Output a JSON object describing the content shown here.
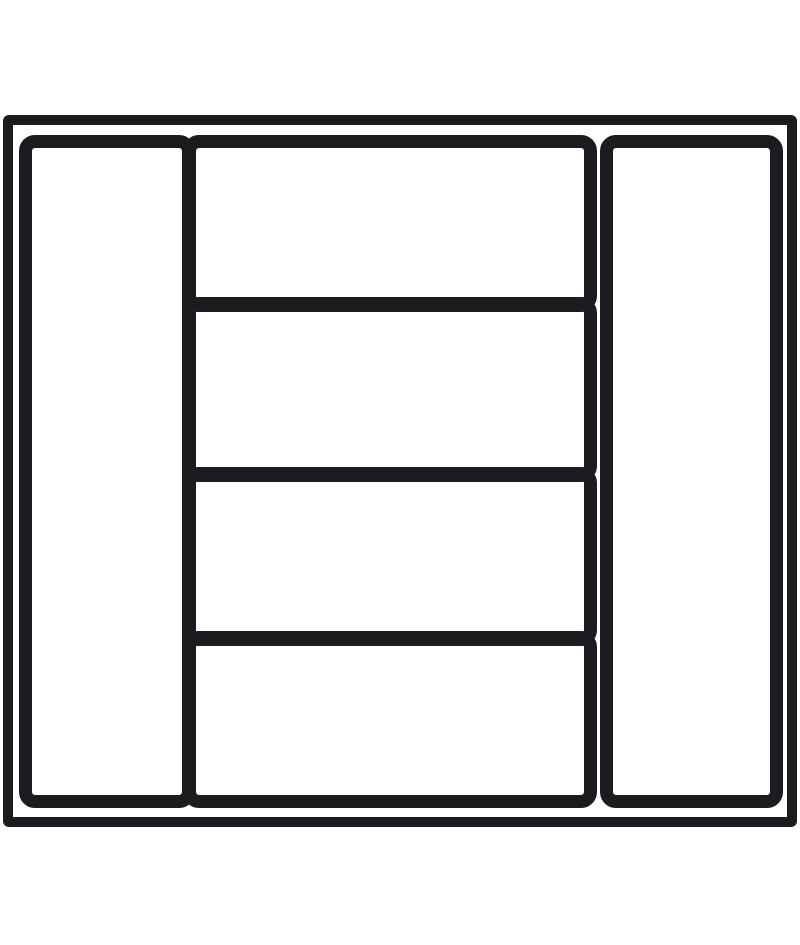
{
  "diagram": {
    "title": "drawer-organizer-cutlery-tray-top-view",
    "background_color": "#ffffff",
    "line_color": "#1b1b20",
    "canvas": {
      "width": 800,
      "height": 945
    },
    "outer_frame": {
      "x": 3,
      "y": 115,
      "width": 794,
      "height": 712,
      "stroke": 10,
      "radius": 6
    },
    "compartments": [
      {
        "id": "left-tray",
        "x": 19,
        "y": 135,
        "width": 176,
        "height": 673,
        "stroke": 13,
        "radius": 16
      },
      {
        "id": "middle-tray-1",
        "x": 183,
        "y": 135,
        "width": 414,
        "height": 177,
        "stroke": 13,
        "radius": 16
      },
      {
        "id": "middle-tray-2",
        "x": 183,
        "y": 297,
        "width": 414,
        "height": 185,
        "stroke": 13,
        "radius": 16
      },
      {
        "id": "middle-tray-3",
        "x": 183,
        "y": 467,
        "width": 414,
        "height": 179,
        "stroke": 13,
        "radius": 16
      },
      {
        "id": "middle-tray-4",
        "x": 183,
        "y": 631,
        "width": 414,
        "height": 177,
        "stroke": 13,
        "radius": 16
      },
      {
        "id": "right-tray",
        "x": 600,
        "y": 135,
        "width": 183,
        "height": 673,
        "stroke": 13,
        "radius": 16
      }
    ]
  }
}
